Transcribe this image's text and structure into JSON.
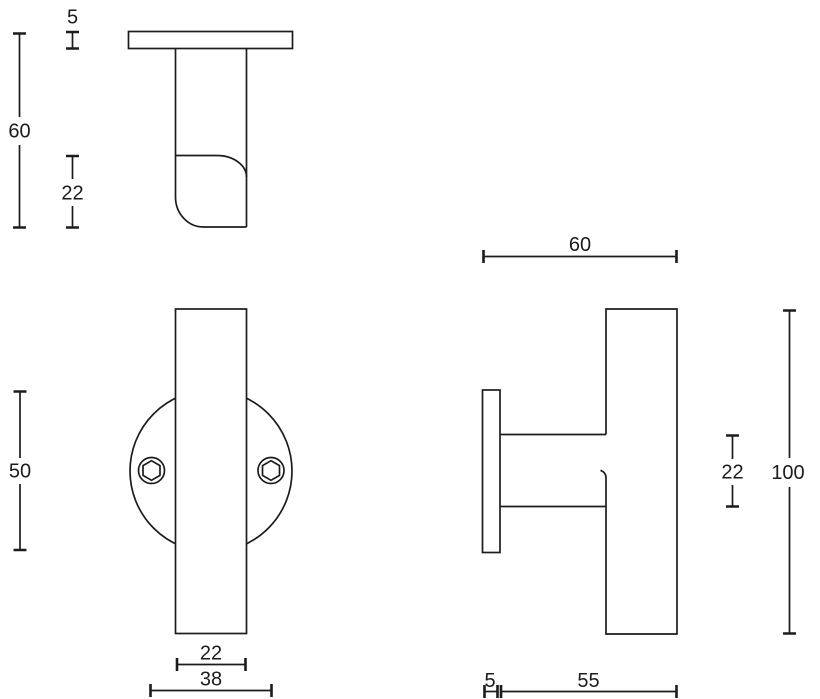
{
  "drawing": {
    "background_color": "#ffffff",
    "line_color": "#1c1c1c",
    "views": {
      "top_view": {
        "dim_plate_thickness": "5",
        "dim_overall_projection": "60",
        "dim_bar_section": "22"
      },
      "front_view": {
        "dim_rosette_diameter": "50",
        "dim_bar_width": "22",
        "dim_screw_spacing": "38"
      },
      "side_view": {
        "dim_bar_length": "60",
        "dim_neck_diameter": "22",
        "dim_bar_height": "100",
        "dim_plate_thickness": "5",
        "dim_depth": "55"
      }
    }
  }
}
